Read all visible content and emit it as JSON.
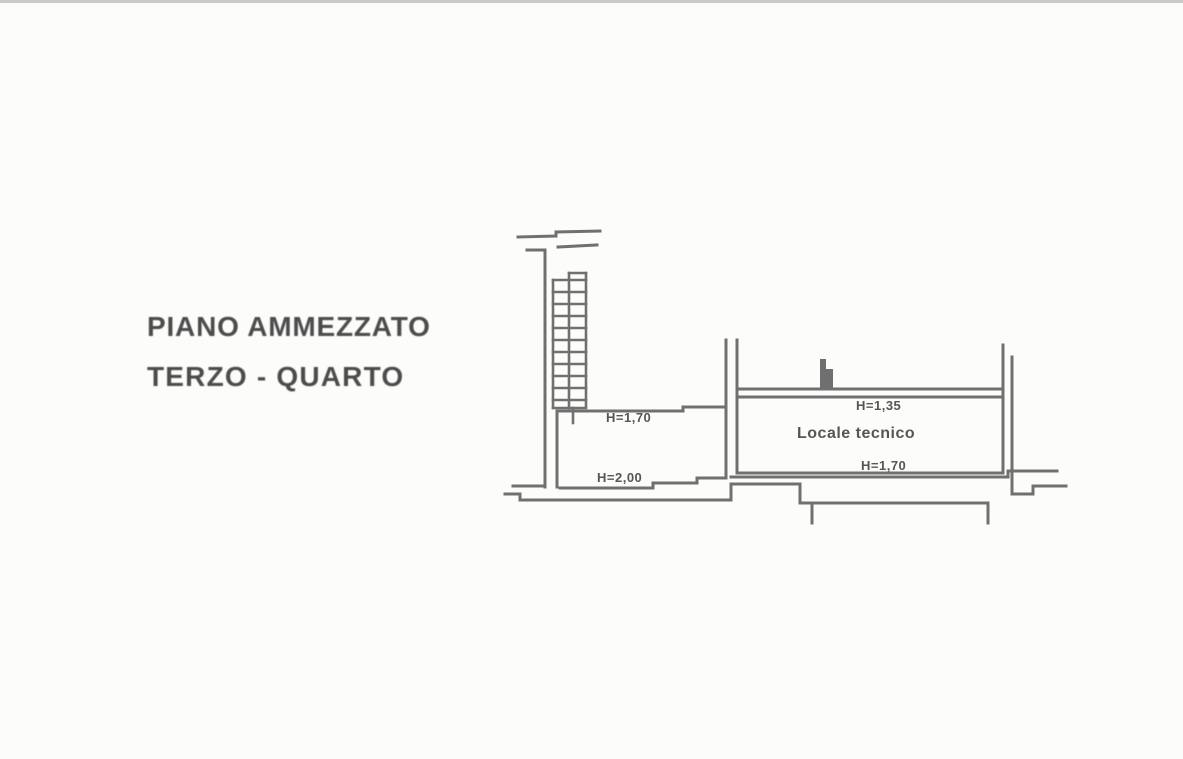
{
  "page": {
    "background": "#fcfcfa",
    "line_color": "#707070",
    "text_color": "#4c4c4c"
  },
  "title": {
    "line1": "PIANO AMMEZZATO",
    "line2": "TERZO - QUARTO"
  },
  "plan": {
    "room_label": "Locale tecnico",
    "heights": {
      "mezzanine_upper": "H=1,70",
      "mezzanine_lower": "H=2,00",
      "room_upper": "H=1,35",
      "room_lower": "H=1,70"
    }
  }
}
